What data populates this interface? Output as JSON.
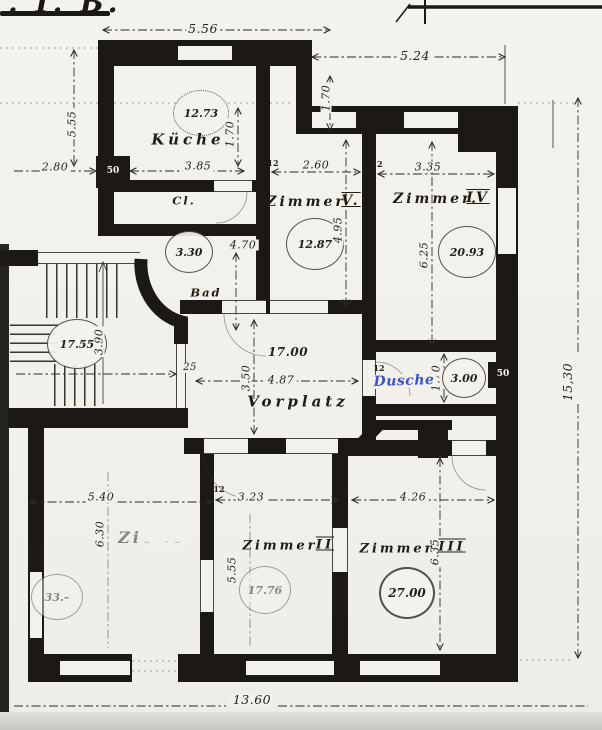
{
  "title": {
    "fragment": ". I. B."
  },
  "colors": {
    "paper": "#f3f1ec",
    "ink": "#1b1815",
    "blue": "#3a54c4"
  },
  "dims": {
    "d556": "5.56",
    "d524": "5.24",
    "d170": "1.70",
    "d555_left": "5.55",
    "d280": "2.80",
    "d385": "3.85",
    "d260": "2.60",
    "d335": "3.35",
    "d495": "4.95",
    "d625": "6.25",
    "d470": "4.70",
    "d487": "4.87",
    "d350": "3.50",
    "d390": "3.90",
    "d1530": "15,30",
    "d540": "5.40",
    "d630": "6.30",
    "d323": "3.23",
    "d555_z2": "5.55",
    "d426": "4.26",
    "d635": "6.35",
    "d1360": "13.60"
  },
  "rooms": {
    "kueche": {
      "label": "Küche",
      "area": "12.73"
    },
    "cl": {
      "label": "Cl.",
      "area": "3.30"
    },
    "bad": {
      "label": "Bad"
    },
    "treppe": {
      "area": "17.55"
    },
    "vorplatz": {
      "label": "Vorplatz",
      "area": "17.00"
    },
    "zimmer5": {
      "label": "Zimmer",
      "numeral": "V.",
      "area": "12.87"
    },
    "zimmer4": {
      "label": "Zimmer.",
      "numeral": "IV",
      "area": "20.93"
    },
    "dusche": {
      "label": "Dusche",
      "area": "3.00"
    },
    "zimmer1": {
      "label": "Zi",
      "label_faded": "– ·–",
      "area": "33.–"
    },
    "zimmer2": {
      "label": "Zimmer",
      "numeral": "II",
      "area": "17.76"
    },
    "zimmer3": {
      "label": "Zimmer",
      "numeral": "III",
      "area": "27.00"
    }
  },
  "markers": {
    "m50": "50",
    "m12": "12",
    "m25": "25"
  }
}
